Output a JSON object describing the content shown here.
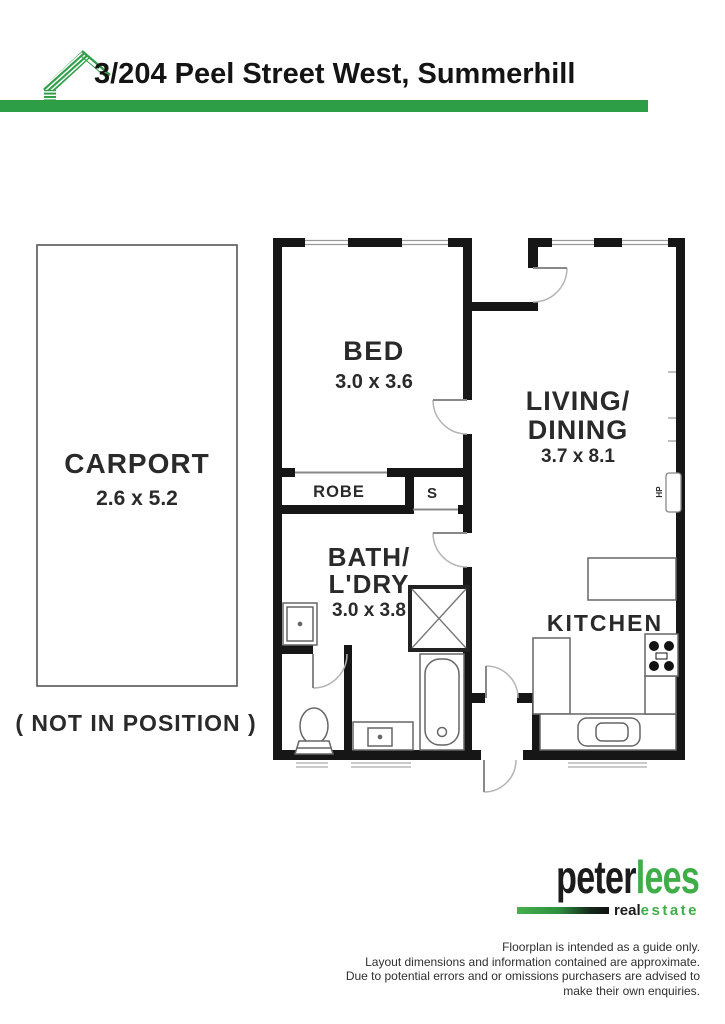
{
  "header": {
    "address": "3/204 Peel Street West, Summerhill"
  },
  "plan": {
    "carport": {
      "label": "CARPORT",
      "dims": "2.6 x 5.2",
      "note": "( NOT IN POSITION )"
    },
    "bed": {
      "label": "BED",
      "dims": "3.0 x 3.6"
    },
    "living": {
      "label_line1": "LIVING/",
      "label_line2": "DINING",
      "dims": "3.7 x 8.1"
    },
    "bath": {
      "label_line1": "BATH/",
      "label_line2": "L'DRY",
      "dims": "3.0 x 3.8"
    },
    "kitchen": {
      "label": "KITCHEN"
    },
    "robe": {
      "label": "ROBE"
    },
    "store": {
      "label": "S"
    },
    "heat_pump": {
      "label": "HP"
    }
  },
  "brand": {
    "name_primary": "peter",
    "name_accent": "lees",
    "tag_primary": "real",
    "tag_accent": "estate"
  },
  "disclaimer": {
    "lines": [
      "Floorplan is intended as a guide only.",
      "Layout dimensions and information contained are approximate.",
      "Due to potential errors and or omissions purchasers are advised to",
      "make their own enquiries."
    ]
  },
  "colors": {
    "accent_green": "#2d9e46",
    "logo_green": "#3fae49",
    "wall": "#161616"
  }
}
